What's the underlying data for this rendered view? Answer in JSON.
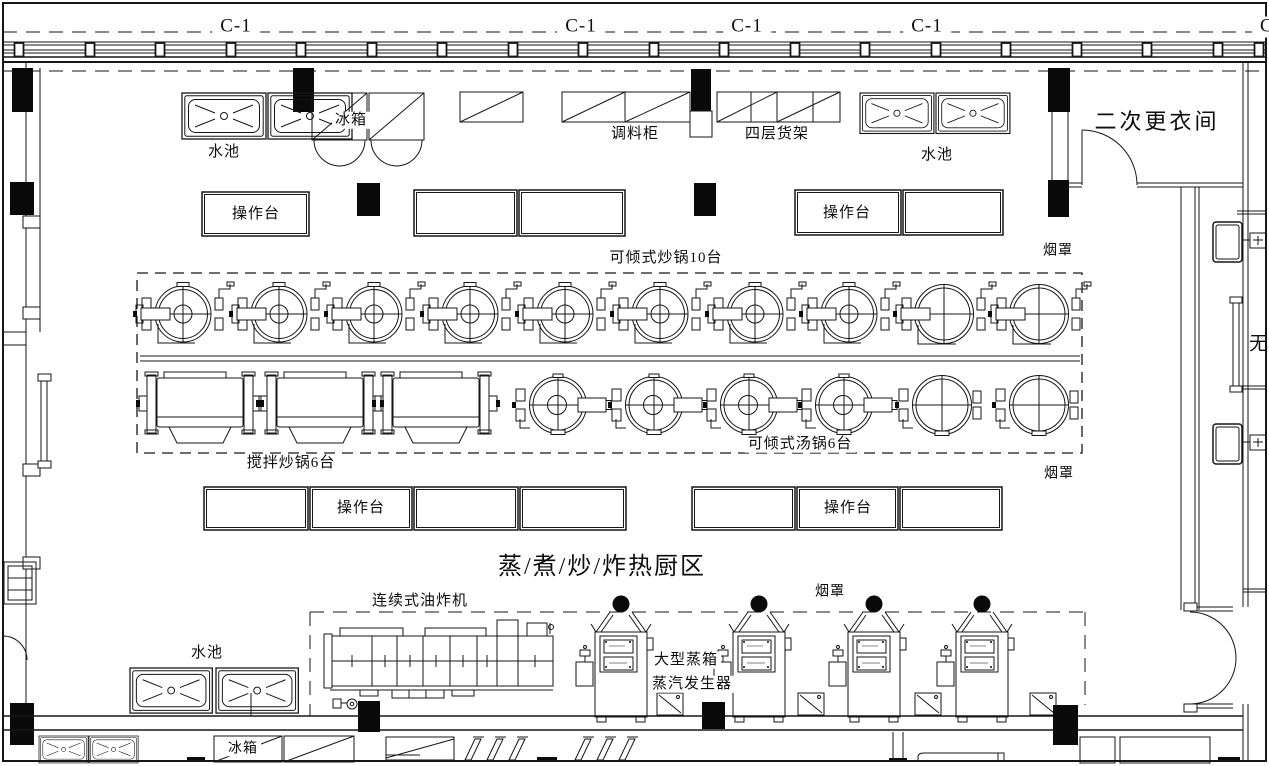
{
  "plan": {
    "grid": {
      "c1_a": "C-1",
      "c1_b": "C-1",
      "c1_c": "C-1",
      "c1_d": "C-1",
      "c1_e": "C-1"
    },
    "rooms": {
      "changing_room": "二次更衣间",
      "hot_kitchen": "蒸/煮/炒/炸热厨区",
      "right_partial": "无"
    },
    "labels": {
      "sink_tl": "水池",
      "sink_tr": "水池",
      "sink_bl": "水池",
      "fridge_top": "冰箱",
      "fridge_bottom": "冰箱",
      "seasoning_cabinet": "调料柜",
      "shelf4": "四层货架",
      "worktable_r1_left": "操作台",
      "worktable_r1_right": "操作台",
      "worktable_r2_left": "操作台",
      "worktable_r2_right": "操作台",
      "wok10": "可倾式炒锅10台",
      "mixwok6": "搅拌炒锅6台",
      "souppot6": "可倾式汤锅6台",
      "hood_r1": "烟罩",
      "hood_r2": "烟罩",
      "hood_bottom": "烟罩",
      "fryer": "连续式油炸机",
      "steam_cabinet": "大型蒸箱",
      "steam_generator": "蒸汽发生器"
    },
    "colors": {
      "line": "#161616",
      "background": "#ffffff"
    }
  }
}
